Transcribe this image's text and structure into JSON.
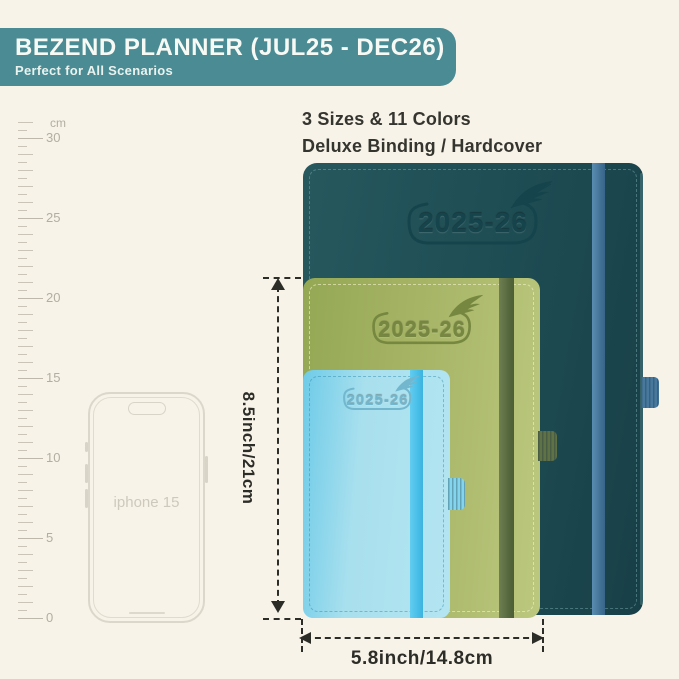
{
  "banner": {
    "title": "BEZEND PLANNER (JUL25 - DEC26)",
    "subtitle": "Perfect for All Scenarios",
    "bg_color": "#4a8b94"
  },
  "headline": {
    "line1": "3 Sizes & 11 Colors",
    "line2": "Deluxe Binding / Hardcover"
  },
  "ruler": {
    "unit": "cm",
    "labels": [
      "30",
      "25",
      "20",
      "15",
      "10",
      "5",
      "0"
    ]
  },
  "phone": {
    "label": "iphone 15"
  },
  "planners": {
    "large": {
      "year": "2025-26",
      "cover_color": "#1f4f56",
      "band_color": "#47799e"
    },
    "medium": {
      "year": "2025-26",
      "cover_color": "#a0b15f",
      "band_color": "#5d6f44"
    },
    "small": {
      "year": "2025-26",
      "cover_color": "#a9e0ee",
      "band_color": "#44bce6"
    }
  },
  "dimensions": {
    "height_label": "8.5inch/21cm",
    "width_label": "5.8inch/14.8cm"
  }
}
